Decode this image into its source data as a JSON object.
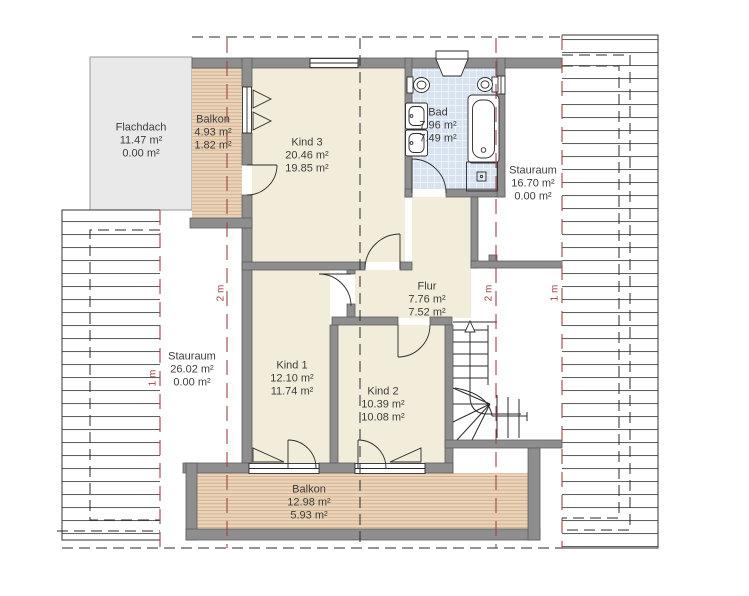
{
  "plan_title": "Obergeschoss Grundriss",
  "rooms": {
    "flachdach": {
      "name": "Flachdach",
      "area1": "11.47 m²",
      "area2": "0.00 m²"
    },
    "balkon_top": {
      "name": "Balkon",
      "area1": "4.93 m²",
      "area2": "1.82 m²"
    },
    "kind3": {
      "name": "Kind 3",
      "area1": "20.46 m²",
      "area2": "19.85 m²"
    },
    "bad": {
      "name": "Bad",
      "area1": "7.96 m²",
      "area2": "7.49 m²"
    },
    "stauraum_right": {
      "name": "Stauraum",
      "area1": "16.70 m²",
      "area2": "0.00 m²"
    },
    "stauraum_left": {
      "name": "Stauraum",
      "area1": "26.02 m²",
      "area2": "0.00 m²"
    },
    "kind1": {
      "name": "Kind 1",
      "area1": "12.10 m²",
      "area2": "11.74 m²"
    },
    "kind2": {
      "name": "Kind 2",
      "area1": "10.39 m²",
      "area2": "10.08 m²"
    },
    "flur": {
      "name": "Flur",
      "area1": "7.76 m²",
      "area2": "7.52 m²"
    },
    "balkon_bottom": {
      "name": "Balkon",
      "area1": "12.98 m²",
      "area2": "5.93 m²"
    }
  },
  "height_markers": {
    "left_1m": "1 m",
    "left_2m": "2 m",
    "right_2m": "2 m",
    "right_1m": "1 m"
  },
  "colors": {
    "wall_gray": "#8e8e8e",
    "room_cream": "#f2ecda",
    "tile_blue": "#d9e3f0",
    "wood_tone": "#ead3b8",
    "flat_roof_gray": "#e9e9e9",
    "height_line_red": "#9c4545"
  }
}
